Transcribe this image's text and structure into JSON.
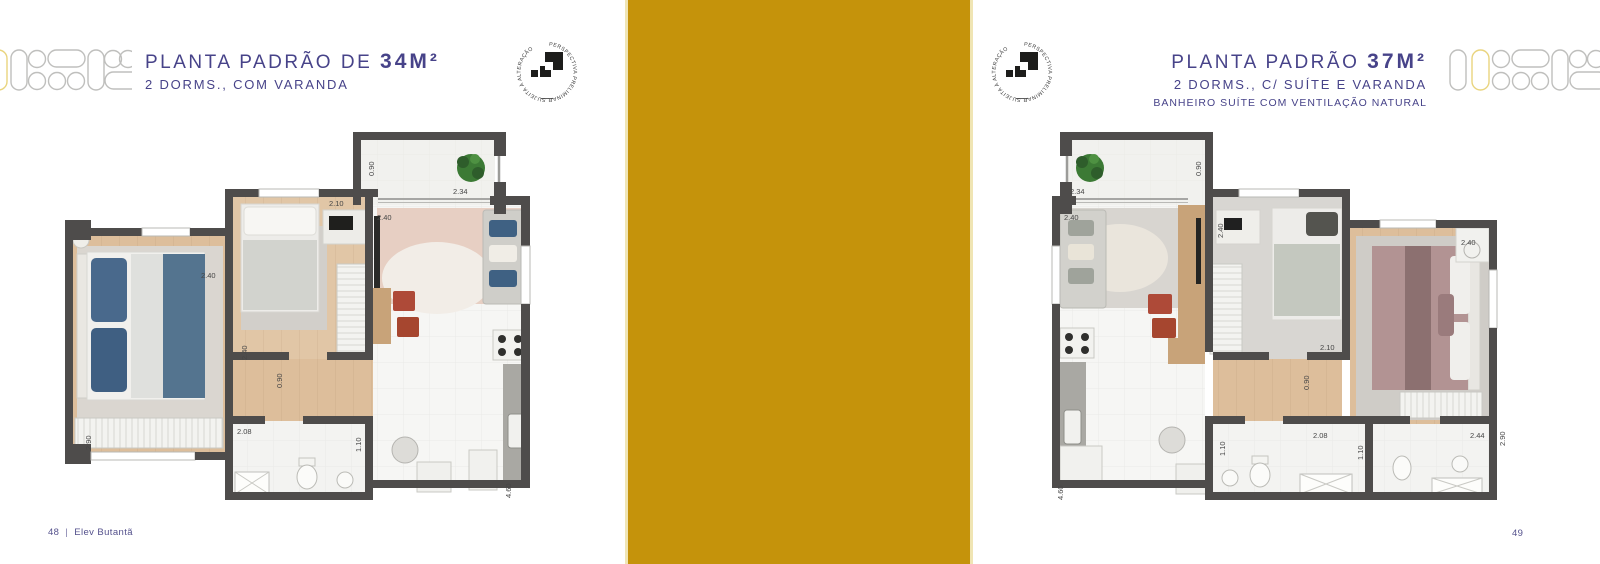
{
  "left_page": {
    "title_prefix": "PLANTA PADRÃO DE",
    "title_area": "34M²",
    "subtitle": "2 DORMS., COM VARANDA",
    "footer": {
      "page": "48",
      "separator": "|",
      "brand": "Elev Butantã"
    },
    "dims": [
      {
        "v": "0.90"
      },
      {
        "v": "2.34"
      },
      {
        "v": "2.10"
      },
      {
        "v": "2.40"
      },
      {
        "v": "2.40"
      },
      {
        "v": "2.40"
      },
      {
        "v": "0.90"
      },
      {
        "v": "2.08"
      },
      {
        "v": "1.10"
      },
      {
        "v": "2.90"
      },
      {
        "v": "4.60"
      }
    ]
  },
  "right_page": {
    "title_prefix": "PLANTA PADRÃO",
    "title_area": "37M²",
    "subtitle": "2 DORMS., C/ SUÍTE E VARANDA",
    "note": "BANHEIRO SUÍTE COM VENTILAÇÃO NATURAL",
    "footer": {
      "page": "49"
    },
    "dims": [
      {
        "v": "2.34"
      },
      {
        "v": "0.90"
      },
      {
        "v": "2.40"
      },
      {
        "v": "2.40"
      },
      {
        "v": "2.10"
      },
      {
        "v": "0.90"
      },
      {
        "v": "1.10"
      },
      {
        "v": "2.08"
      },
      {
        "v": "1.10"
      },
      {
        "v": "2.40"
      },
      {
        "v": "2.90"
      },
      {
        "v": "2.44"
      },
      {
        "v": "4.60"
      }
    ]
  },
  "stamp": {
    "text": "PERSPECTIVA PRELIMINAR SUJEITA À ALTERAÇÃO"
  },
  "colors": {
    "gold_band": "#C5930B",
    "gold_band_edge": "#F0E5B4",
    "heading_purple": "#474389",
    "wall": "#4E4C4B",
    "wood_floor": "#DDBE9B",
    "accent_yellow_outline": "#E9D47E",
    "red_chair": "#AE4A38"
  }
}
